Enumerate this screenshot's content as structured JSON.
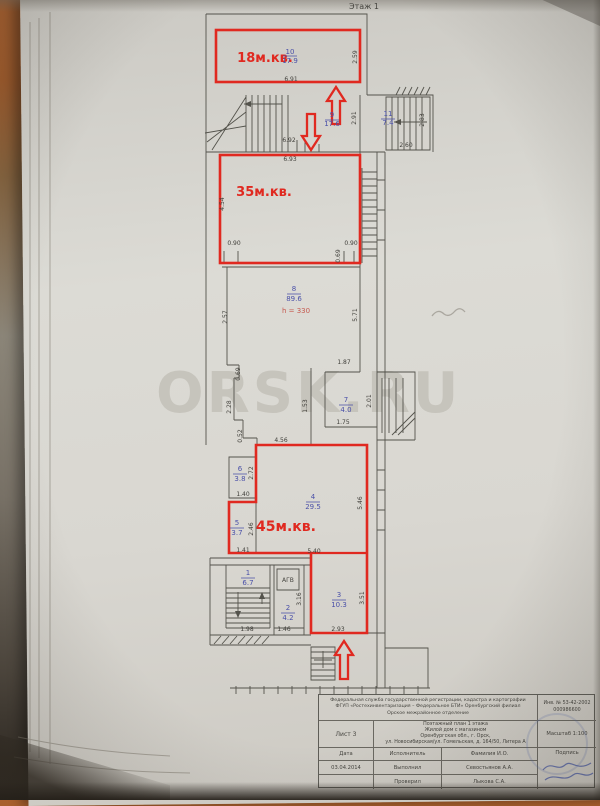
{
  "colors": {
    "annotation_red": "#e02920",
    "room_number_blue": "#4a50a8",
    "pencil": "#6e695f"
  },
  "plan": {
    "floor_label": "Этаж 1",
    "watermark": "ORSK.RU",
    "height_note": "h = 330",
    "boiler_label": "АГВ",
    "red_area_labels": {
      "top": "18м.кв.",
      "middle": "35м.кв.",
      "bottom": "45м.кв."
    },
    "rooms": {
      "r10": {
        "num": "10",
        "area": "17.9"
      },
      "r9": {
        "num": "9",
        "area": "17.6"
      },
      "r11": {
        "num": "11",
        "area": "7.4"
      },
      "r8": {
        "num": "8",
        "area": "89.6"
      },
      "r7": {
        "num": "7",
        "area": "4.0"
      },
      "r6": {
        "num": "6",
        "area": "3.8"
      },
      "r5": {
        "num": "5",
        "area": "3.7"
      },
      "r4": {
        "num": "4",
        "area": "29.5"
      },
      "r1": {
        "num": "1",
        "area": "6.7"
      },
      "r2": {
        "num": "2",
        "area": "4.2"
      },
      "r3": {
        "num": "3",
        "area": "10.3"
      }
    },
    "dims": {
      "r10_w": "6.91",
      "r10_h": "2.59",
      "landing_w": "6.92",
      "landing_h": "2.91",
      "stair2_w": "2.60",
      "stair2_h": "2.83",
      "r35_w": "6.93",
      "r35_h": "4.54",
      "r35_door_l": "0.90",
      "r35_door_r": "0.90",
      "r35_jog": "0.69",
      "r8_left": "2.57",
      "r8_right": "5.71",
      "r8_bot": "1.87",
      "jog1": "0.69",
      "jog2": "2.28",
      "jog3": "0.52",
      "r7_left": "1.53",
      "r7_right": "2.01",
      "r7_bot": "1.75",
      "r4_top": "4.56",
      "r6_h": "2.72",
      "r6_w": "1.40",
      "r5_h": "2.46",
      "r5_w": "1.41",
      "r4_right": "5.46",
      "r4_bot": "5.40",
      "agv_h": "3.16",
      "stair3_w": "1.98",
      "r2_w": "1.46",
      "r3_w": "2.93",
      "r3_h": "3.51"
    }
  },
  "titleblock": {
    "org1": "Федеральная служба государственной регистрации, кадастра и картографии",
    "org2": "ФГУП «Ростехинвентаризация – Федеральное БТИ» Оренбургский филиал",
    "org3": "Орское межрайонное отделение",
    "inv1": "Инв. № 53-42-2002",
    "inv2": "000986600",
    "sheet": "Лист 3",
    "obj1": "Поэтажный план 1 этажа",
    "obj2": "Жилой дом с магазином",
    "obj3": "Оренбургская обл., г. Орск,",
    "obj4": "ул. Новосибирская/ул. Гомельская, д. 164/50, Литера А",
    "scale": "Масштаб 1:100",
    "hdr_date": "Дата",
    "hdr_role": "Исполнитель",
    "hdr_name": "Фамилия И.О.",
    "hdr_sign": "Подпись",
    "date": "03.04.2014",
    "row1_role": "Выполнил",
    "row1_name": "Севостьянов А.А.",
    "row2_role": "Проверил",
    "row2_name": "Лыкова С.А."
  }
}
